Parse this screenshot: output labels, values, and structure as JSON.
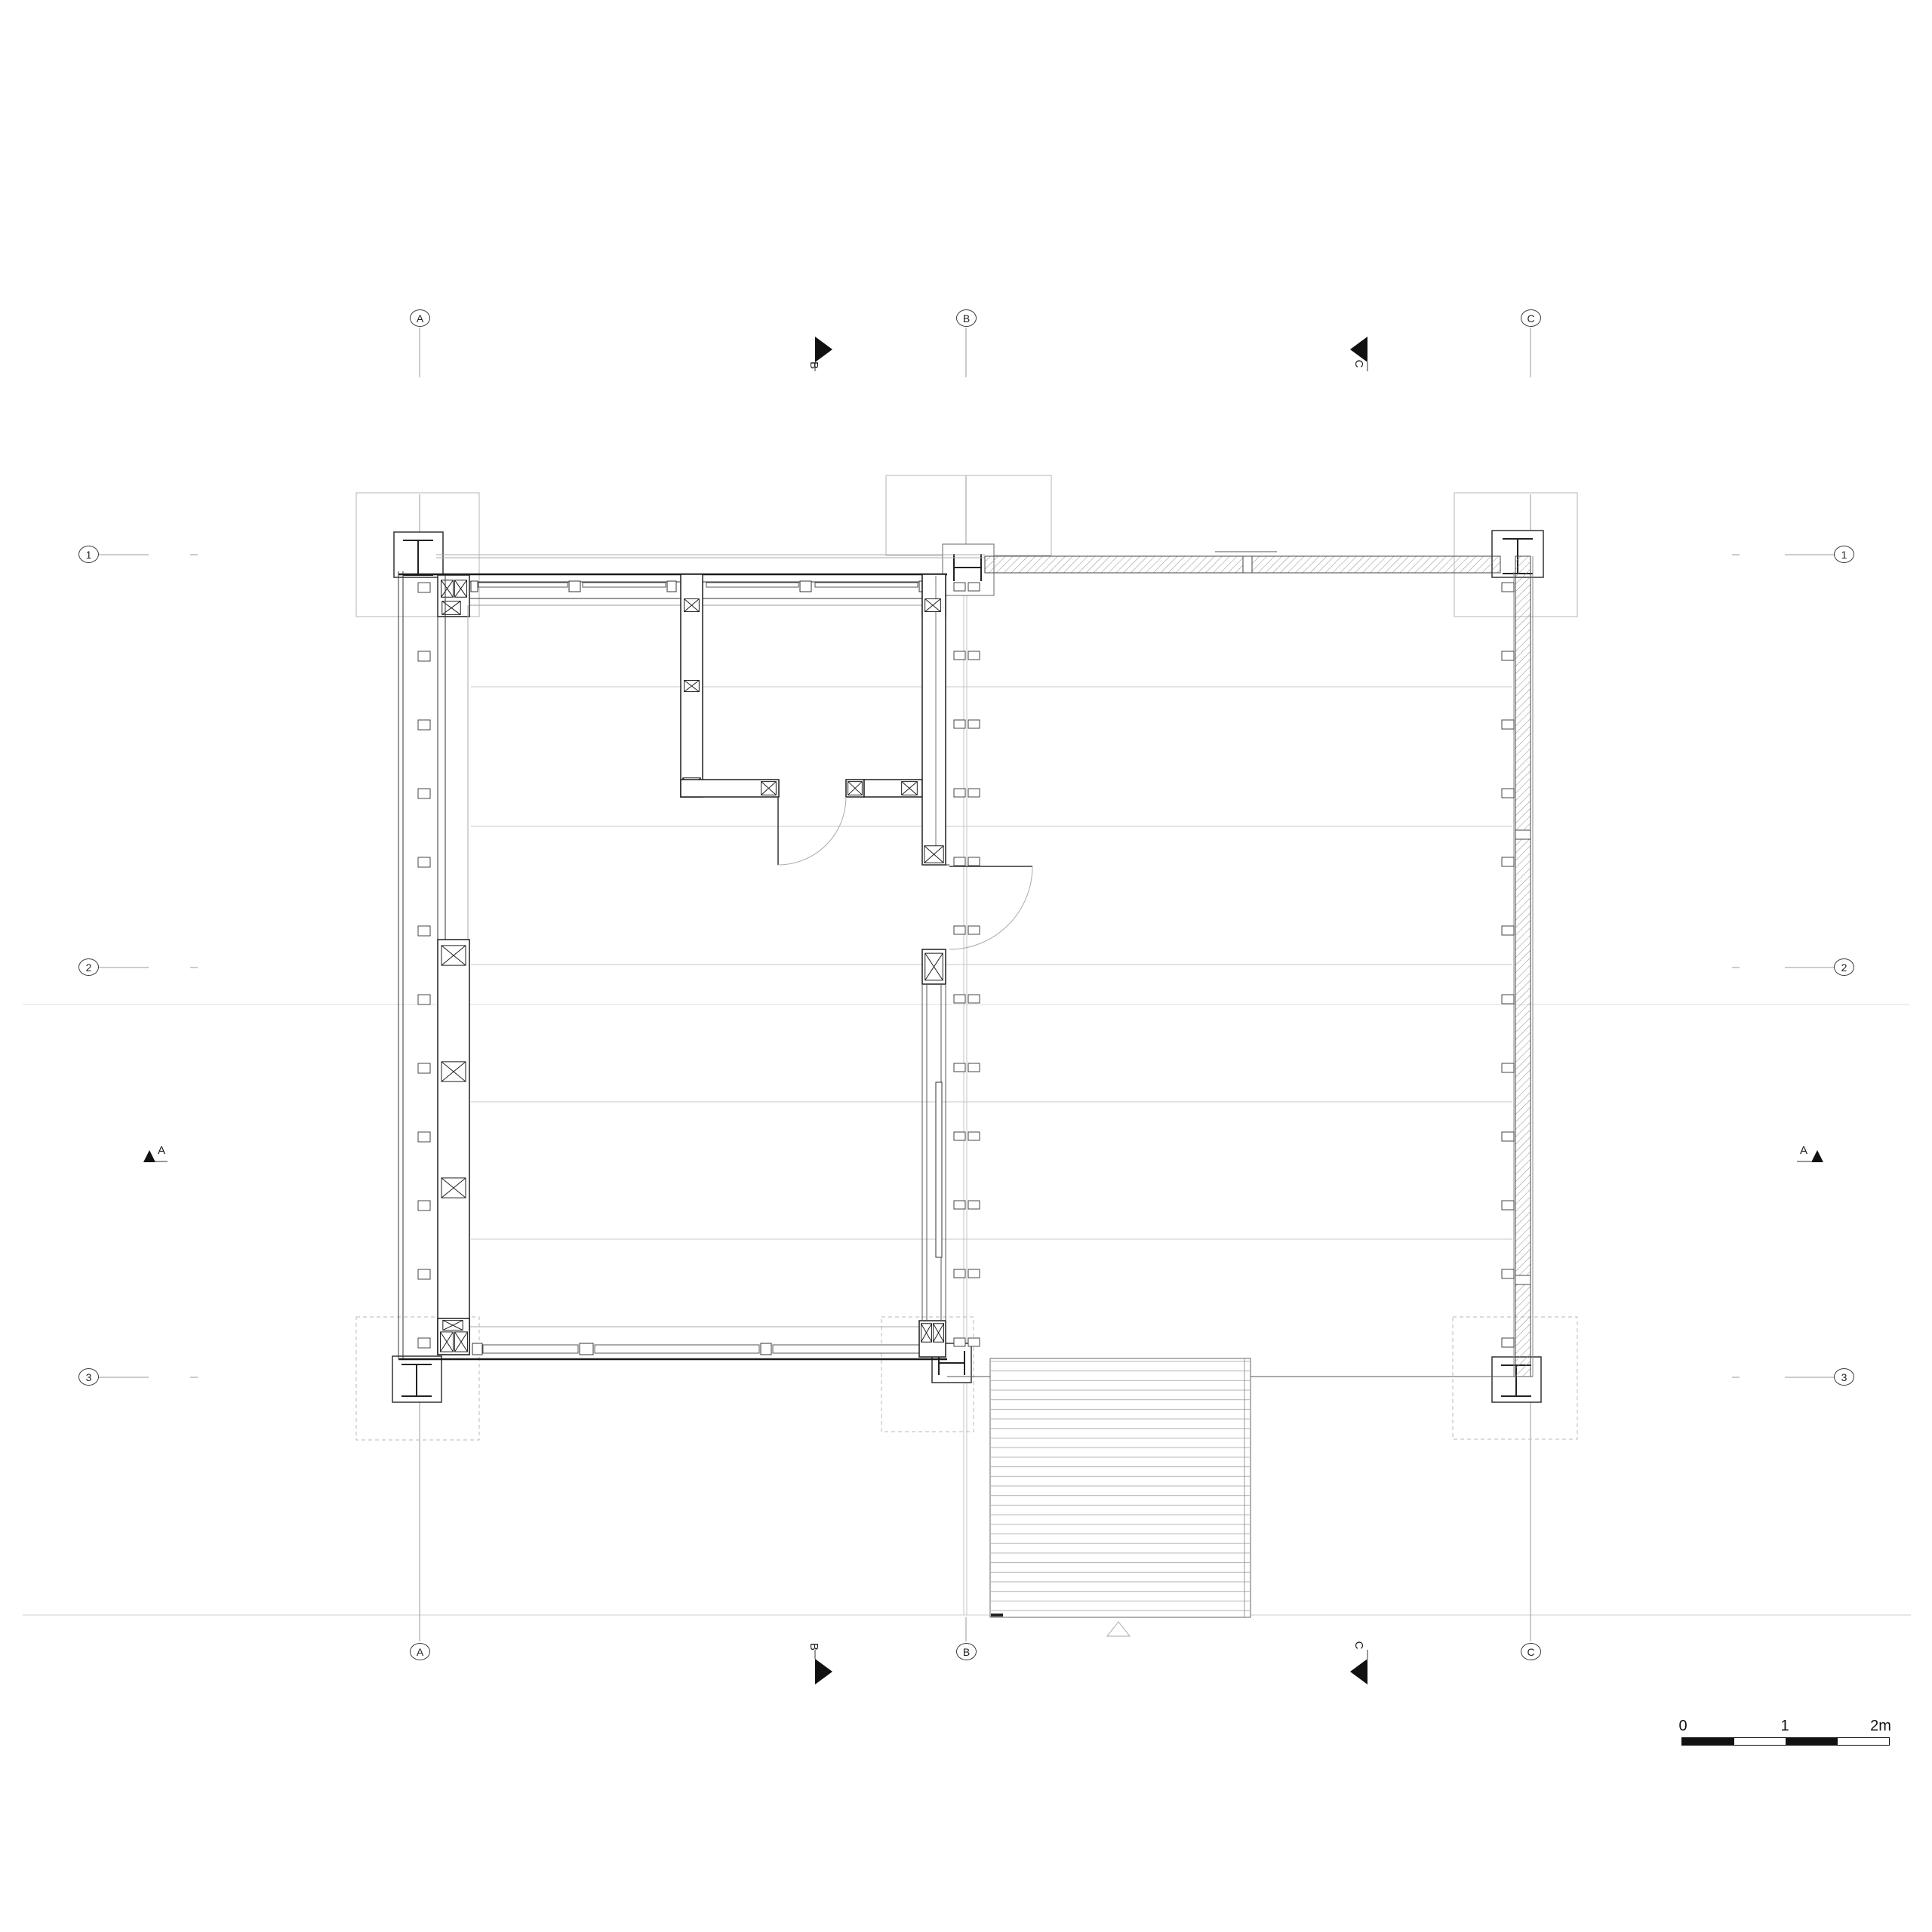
{
  "grid": {
    "top": [
      "A",
      "B",
      "C"
    ],
    "bottom": [
      "A",
      "B",
      "C"
    ],
    "left": [
      "1",
      "2",
      "3"
    ],
    "right": [
      "1",
      "2",
      "3"
    ]
  },
  "sections": {
    "left_a": "A",
    "right_a": "A",
    "top_b": "B",
    "top_c": "C",
    "bottom_b": "B",
    "bottom_c": "C"
  },
  "scale_bar": {
    "tick_0": "0",
    "tick_1": "1",
    "tick_2": "2m"
  },
  "colors": {
    "line_dark": "#1a1a1a",
    "line_mid": "#555555",
    "line_light": "#999999",
    "line_faint": "#c9c9c9",
    "scale_black": "#111111"
  }
}
